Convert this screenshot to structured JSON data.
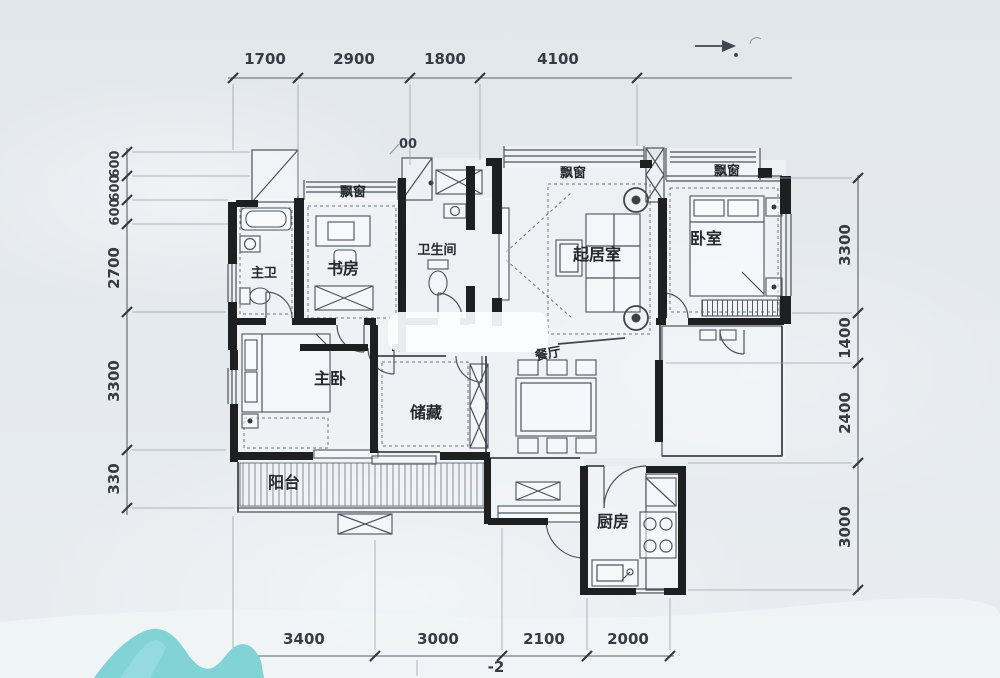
{
  "title": "apartment-floor-plan",
  "colors": {
    "background": "#e4e9ed",
    "wall": "#1d1f21",
    "line": "#4c535a",
    "dimension_text": "#363c42",
    "room_text": "#24292e",
    "decor_teal": "#82d3d6"
  },
  "dimensions": {
    "top": [
      "1700",
      "2900",
      "1800",
      "4100"
    ],
    "bottom": [
      "3400",
      "3000",
      "2100",
      "2000"
    ],
    "left": [
      "600",
      "600",
      "600",
      "2700",
      "3300",
      "330"
    ],
    "right": [
      "3300",
      "1400",
      "2400",
      "3000"
    ]
  },
  "rooms": {
    "master_bath": "主卫",
    "study": "书房",
    "bathroom": "卫生间",
    "living_room": "起居室",
    "bedroom": "卧室",
    "master_bedroom": "主卧",
    "storage": "储藏",
    "dining": "餐厅",
    "balcony": "阳台",
    "kitchen": "厨房"
  },
  "bay_windows": [
    "飘窗",
    "飘窗",
    "飘窗"
  ],
  "annotations": {
    "stray_dimension_fragment": "00",
    "stray_mark": "-2"
  }
}
